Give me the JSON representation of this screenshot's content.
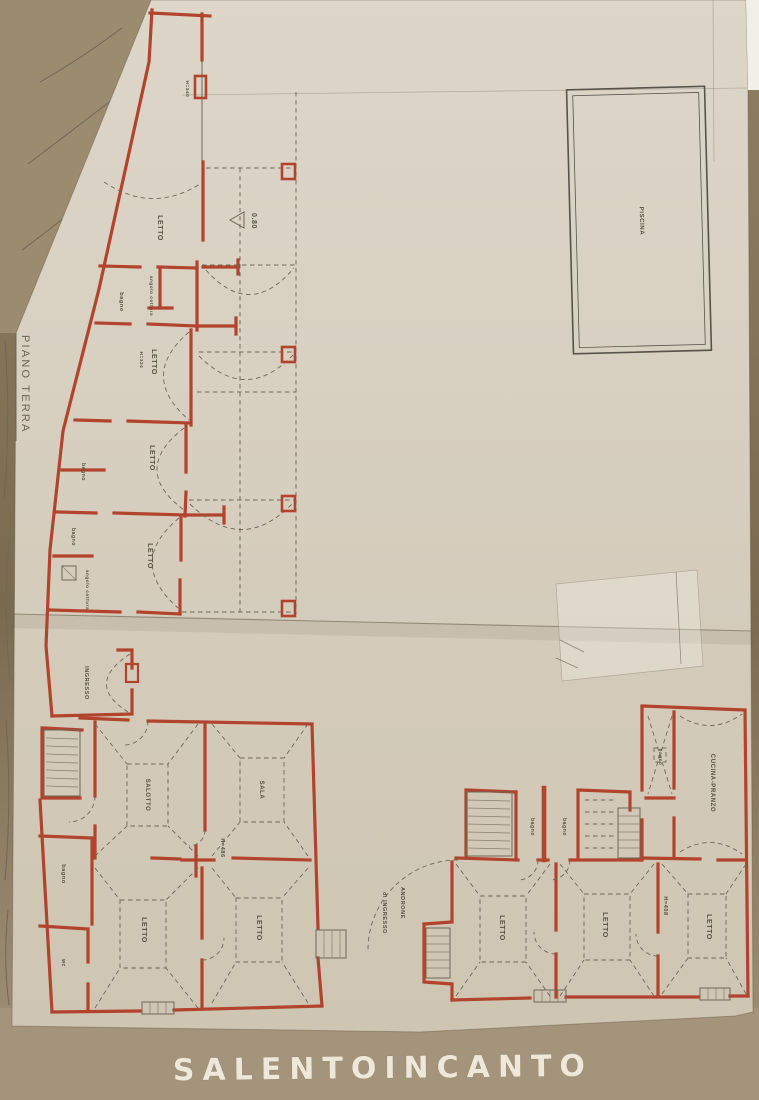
{
  "document": {
    "side_title": "PIANO TERRA",
    "watermark": "SALENTOINCANTO"
  },
  "upper_wing": {
    "letto_top": "LETTO",
    "height_top": "H=340",
    "bagno_1": "bagno",
    "angolo_cottura_1": "angolo cottura",
    "height_2": "H=324",
    "letto_2": "LETTO",
    "bagno_2": "bagno",
    "letto_3": "LETTO",
    "bagno_3": "bagno",
    "letto_4": "LETTO",
    "angolo_cottura_2": "angolo cottura",
    "ingresso": "INGRESSO",
    "shower_depth": "0.80"
  },
  "pool": {
    "label": "PISCINA"
  },
  "left_apartment": {
    "salotto": "SALOTTO",
    "sala": "SALA",
    "height": "H=486",
    "letto_a": "LETTO",
    "letto_b": "LETTO",
    "bagno": "bagno",
    "wc": "wc"
  },
  "right_apartment": {
    "bagno_a": "bagno",
    "bagno_b": "bagno",
    "bagno_c": "bagno",
    "cucina_pranzo": "CUCINA-PRANZO",
    "letto_a": "LETTO",
    "letto_b": "LETTO",
    "letto_c": "LETTO",
    "height": "H=408",
    "androne_line1": "ANDRONE",
    "androne_line2": "di INGRESSO"
  },
  "colors": {
    "wall_red": "#b2432d",
    "pencil_gray": "#6f6757",
    "paper_beige": "#d8d0c1",
    "backdrop_brown": "#8a7a5d",
    "watermark_white": "#eee8da"
  }
}
